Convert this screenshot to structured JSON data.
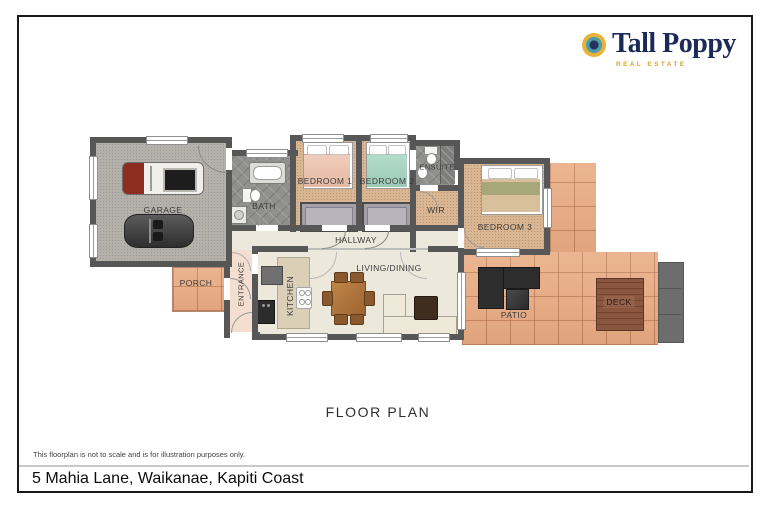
{
  "logo": {
    "brand": "Tall Poppy",
    "tagline": "REAL ESTATE",
    "navy": "#1c2a57",
    "gold": "#d9a430",
    "teal": "#4d9dab"
  },
  "rooms": {
    "garage": "GARAGE",
    "bath": "BATH",
    "bedroom1": "BEDROOM 1",
    "bedroom2": "BEDROOM 2",
    "ensuite": "ENSUITE",
    "wir": "WIR",
    "bedroom3": "BEDROOM 3",
    "hallway": "HALLWAY",
    "porch": "PORCH",
    "entrance": "ENTRANCE",
    "kitchen": "KITCHEN",
    "living": "LIVING/DINING",
    "patio": "PATIO",
    "deck": "DECK"
  },
  "title": "FLOOR PLAN",
  "disclaimer": "This floorplan is not to scale and is for illustration purposes only.",
  "address": "5 Mahia Lane, Waikanae, Kapiti Coast"
}
